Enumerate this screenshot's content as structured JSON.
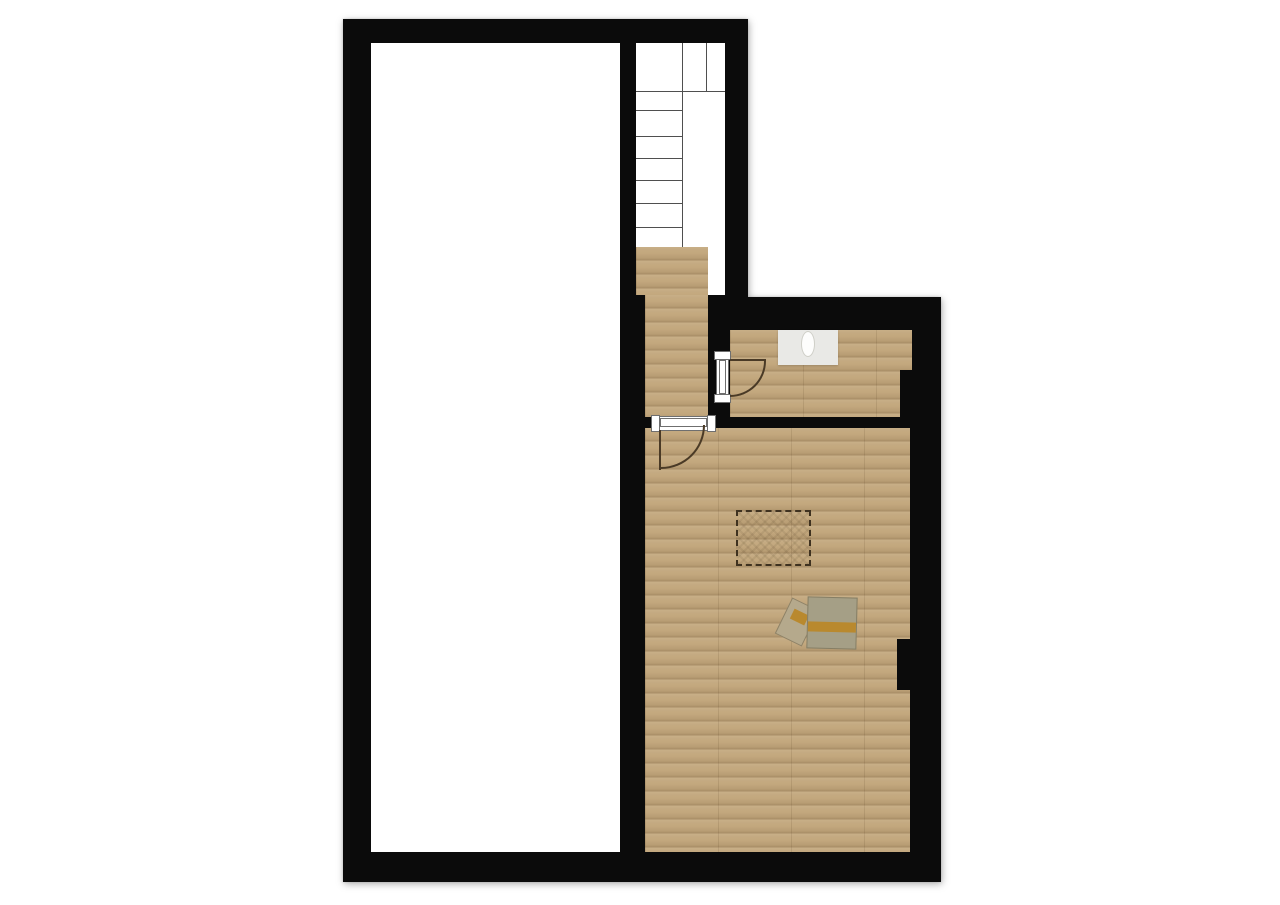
{
  "meta": {
    "type": "floor-plan",
    "description": "Top-down architectural floor plan with thick black walls, an empty white room on the left, a staircase at top center, a wood-floored hallway and two wood-floored rooms on the right, two swing doors, a wall-mounted sink, a dashed ceiling-opening outline and a desk with chair."
  },
  "colors": {
    "wall": "#0b0b0b",
    "stairline": "#4f4f4f",
    "frame": "#6f6f6f",
    "door": "#4a3a26",
    "dash": "#3f3220",
    "sink": "#e9e9e6",
    "basin": "#fdfdfc",
    "desk": "#a59f86",
    "stripe": "#b9892e",
    "chair": "#b5a98c",
    "wood": "#c3a87e"
  },
  "rooms": [
    {
      "id": "left-room",
      "floor": "white/unfinished",
      "contents": "empty"
    },
    {
      "id": "staircase",
      "floor": "white with treads",
      "left_flight_tread_lines": 6,
      "upper_landing_divisions": 3,
      "bottom_landing_floor": "wood"
    },
    {
      "id": "hallway",
      "floor": "wood"
    },
    {
      "id": "top-right-room",
      "floor": "wood",
      "fixtures": [
        "sink"
      ]
    },
    {
      "id": "main-room",
      "floor": "wood",
      "fixtures": [
        "dashed-ceiling-opening",
        "desk-with-chair"
      ]
    }
  ],
  "doors": [
    {
      "id": "door-top-right-room",
      "between": [
        "hallway",
        "top-right-room"
      ],
      "swing": "opens into top-right room"
    },
    {
      "id": "door-main-room",
      "between": [
        "hallway",
        "main-room"
      ],
      "swing": "opens into main room"
    }
  ],
  "fixtures": {
    "sink": {
      "room": "top-right-room",
      "style": "counter with oval basin"
    },
    "desk": {
      "room": "main-room",
      "style": "square top with amber stripe, chair tucked at left"
    },
    "dashed_opening": {
      "room": "main-room",
      "style": "dashed rectangle with cross-hatch"
    }
  }
}
